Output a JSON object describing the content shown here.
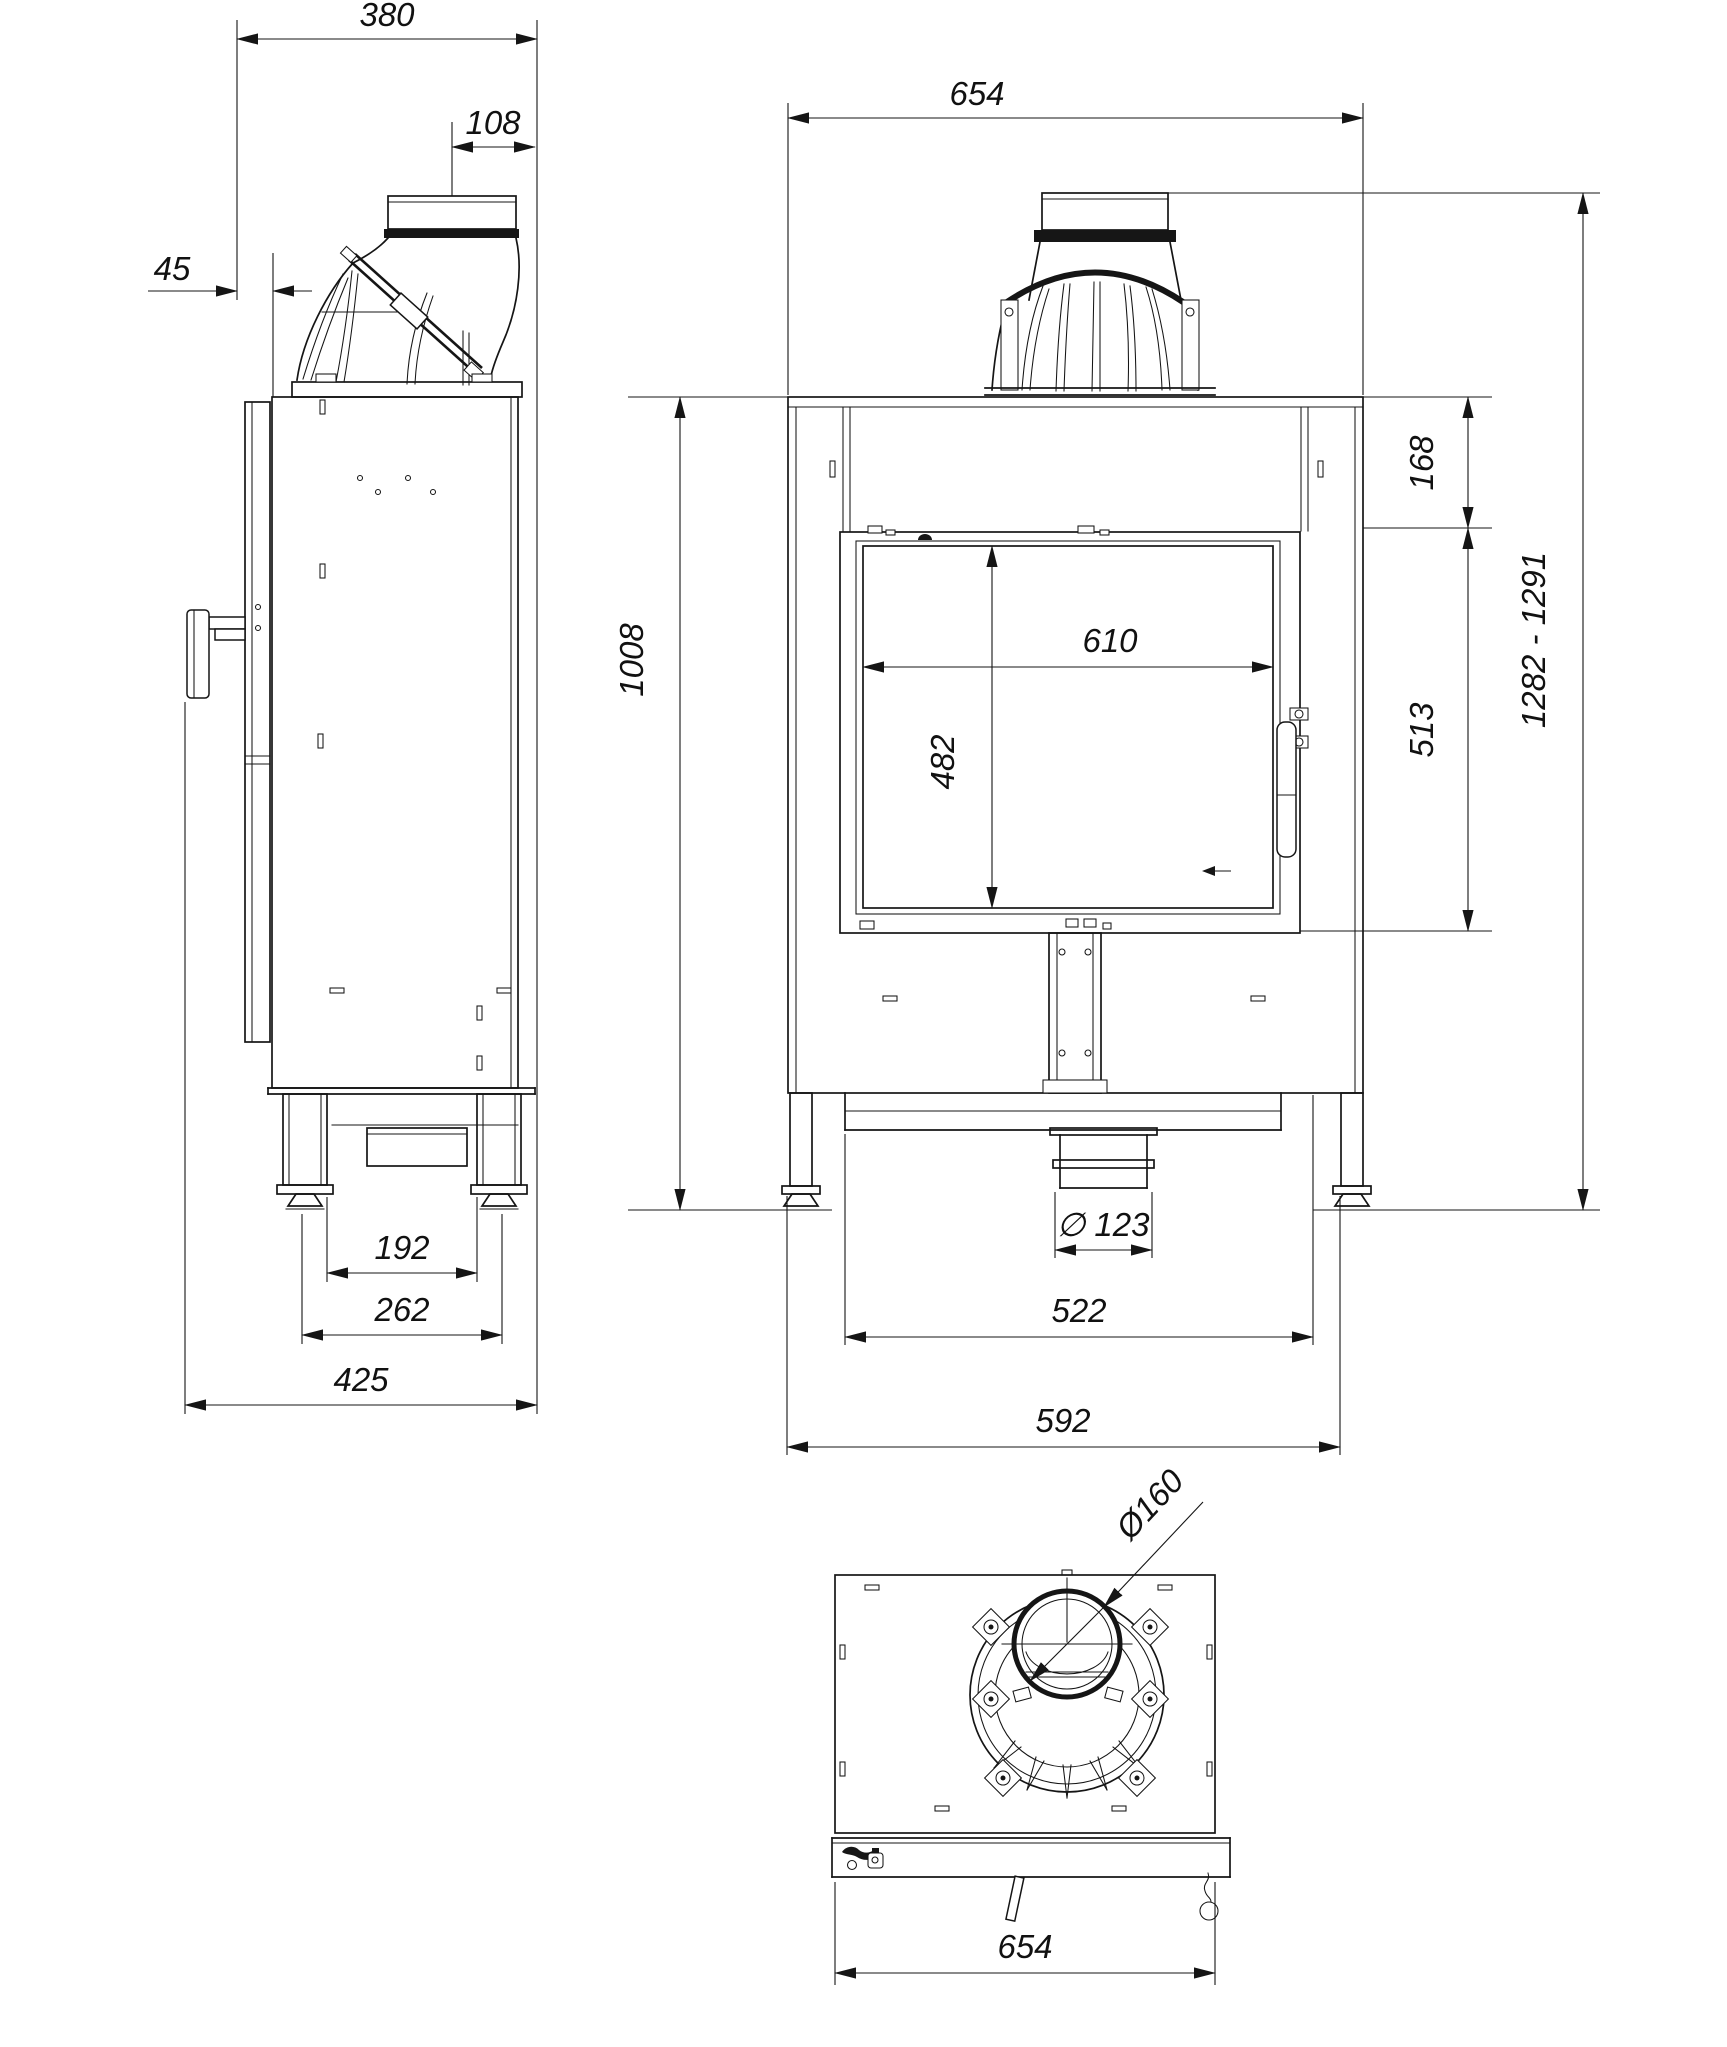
{
  "diagram": {
    "type": "technical-drawing",
    "subject": "fireplace insert - side, front and bottom orthographic views with dimensions (mm)",
    "views": [
      "side-view",
      "front-view",
      "bottom-view"
    ],
    "dimensions": {
      "side_depth": "380",
      "side_flue_offset": "108",
      "side_front_gap": "45",
      "side_leg_span_inner": "192",
      "side_leg_span": "262",
      "side_total_depth": "425",
      "front_width": "654",
      "front_top_band": "168",
      "front_glass_width": "610",
      "front_glass_height": "482",
      "front_door_height": "513",
      "front_body_height": "1008",
      "front_total_height": "1282 - 1291",
      "front_outlet_diameter": "∅ 123",
      "front_base_width_inner": "522",
      "front_base_width": "592",
      "bottom_width": "654",
      "bottom_flue_diameter": "Ø160"
    }
  }
}
